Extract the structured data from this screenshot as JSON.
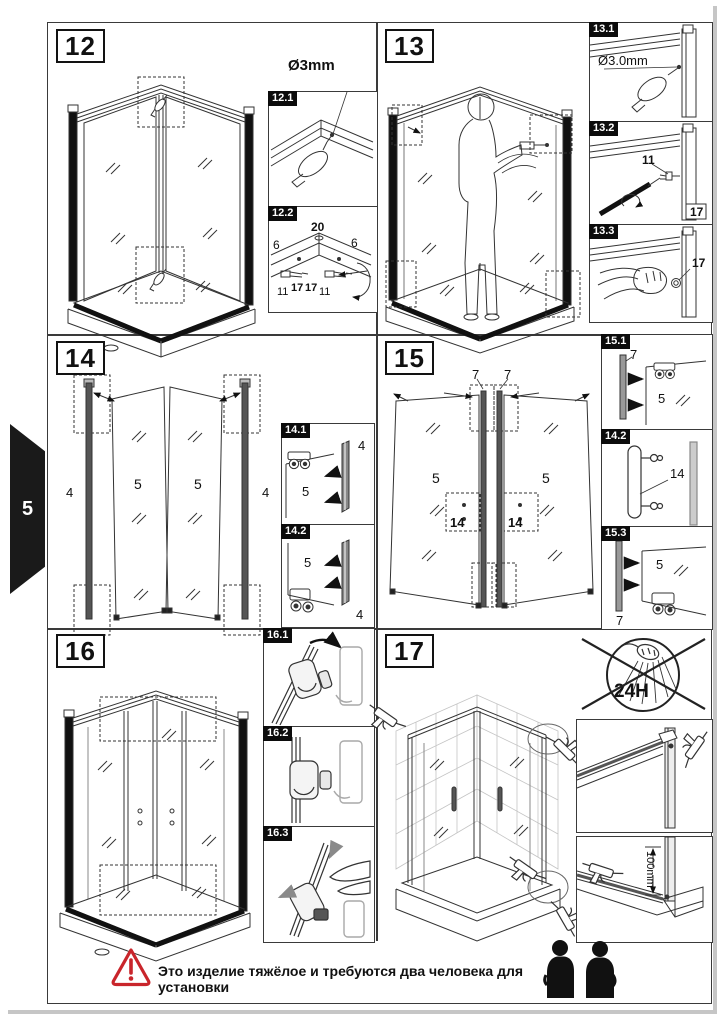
{
  "page": {
    "tab_number": "5",
    "warning_text": "Это изделие тяжёлое и требуются два человека для установки"
  },
  "colors": {
    "accent_red": "#c9252b",
    "ink": "#1a1a1a"
  },
  "steps": {
    "s12": {
      "badge": "12",
      "drill_label": "Ø3mm",
      "sub1": {
        "label": "12.1"
      },
      "sub2": {
        "label": "12.2",
        "n20": "20",
        "n6a": "6",
        "n6b": "6",
        "n11a": "11",
        "n17a": "17",
        "n17b": "17",
        "n11b": "11"
      }
    },
    "s13": {
      "badge": "13",
      "sub1": {
        "label": "13.1",
        "drill_label": "Ø3.0mm"
      },
      "sub2": {
        "label": "13.2",
        "n11": "11",
        "n17": "17"
      },
      "sub3": {
        "label": "13.3",
        "n17": "17"
      }
    },
    "s14": {
      "badge": "14",
      "n4l": "4",
      "n5l": "5",
      "n5r": "5",
      "n4r": "4",
      "sub1": {
        "label": "14.1",
        "n4": "4",
        "n5": "5"
      },
      "sub2": {
        "label": "14.2",
        "n5": "5",
        "n4": "4"
      }
    },
    "s15": {
      "badge": "15",
      "n7l": "7",
      "n7r": "7",
      "n5l": "5",
      "n5r": "5",
      "n14l": "14",
      "n14r": "14",
      "sub1": {
        "label": "15.1",
        "n7": "7",
        "n5": "5"
      },
      "sub2": {
        "label": "14.2",
        "n14": "14"
      },
      "sub3": {
        "label": "15.3",
        "n5": "5",
        "n7": "7"
      }
    },
    "s16": {
      "badge": "16",
      "sub1": {
        "label": "16.1"
      },
      "sub2": {
        "label": "16.2"
      },
      "sub3": {
        "label": "16.3"
      }
    },
    "s17": {
      "badge": "17",
      "no_shower_label": "24H",
      "dim_label": "100mm"
    }
  }
}
